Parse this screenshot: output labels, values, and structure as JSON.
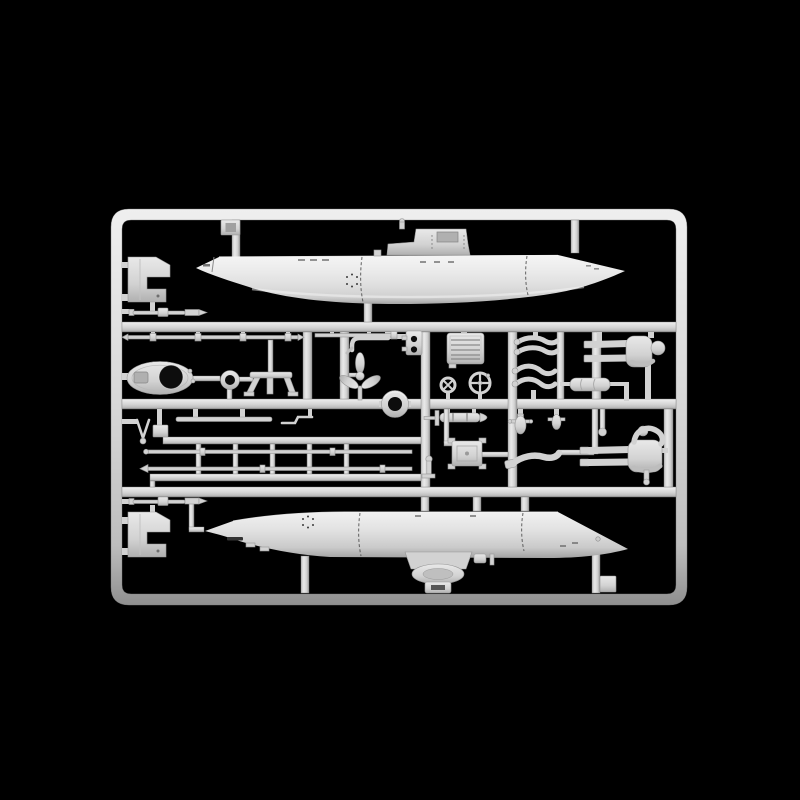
{
  "photo": {
    "subject": "plastic-model-sprue",
    "alt_label": "Light-gray injection-molded model kit sprue on a black background: two midget-submarine hull halves, crew figures, propeller, handwheels, rods and small fittings attached to a rectangular runner frame"
  },
  "colors": {
    "background": "#000000",
    "plastic_base": "#d2d2d2",
    "plastic_light": "#e9e9e9",
    "plastic_highlight": "#f5f5f5",
    "plastic_mid": "#bdbdbd",
    "plastic_shadow": "#8f8f8f",
    "plastic_edge": "#979797",
    "hole_dark": "#0d0d0d",
    "panel_line": "#4a4a4a",
    "recess_gray": "#b0b0b0"
  },
  "sprue": {
    "frame_shape": "rounded-rectangle",
    "parts": [
      {
        "id": "upper-hull-half",
        "label": "submarine upper hull half with conning tower"
      },
      {
        "id": "lower-hull-half",
        "label": "submarine lower hull half with keel drum fitting"
      },
      {
        "id": "mounting-bracket-top",
        "label": "stepped bracket plate"
      },
      {
        "id": "mounting-bracket-bottom",
        "label": "stepped bracket plate"
      },
      {
        "id": "barrel-rod-top",
        "label": "rod with collar and tapered tip"
      },
      {
        "id": "barrel-rod-bottom",
        "label": "rod with collar and tapered tip"
      },
      {
        "id": "pointed-rod-long",
        "label": "long thin rod with arrow tips"
      },
      {
        "id": "pointed-rod-short",
        "label": "short thin rod"
      },
      {
        "id": "rod-rack",
        "label": "ladder of stacked thin rods"
      },
      {
        "id": "zigzag-rod",
        "label": "small z-bent rod"
      },
      {
        "id": "wishbone-part",
        "label": "v-shaped link with eyelet"
      },
      {
        "id": "small-bracket",
        "label": "small square bracket"
      },
      {
        "id": "oval-hatch-coaming",
        "label": "oval plate with round opening"
      },
      {
        "id": "ring-collar",
        "label": "small ring collar"
      },
      {
        "id": "equipment-mount",
        "label": "a-frame equipment mount"
      },
      {
        "id": "towing-hook",
        "label": "hooked rod"
      },
      {
        "id": "hinge-bracket",
        "label": "plate with two holes"
      },
      {
        "id": "vent-grille-panel",
        "label": "rectangular grille panel"
      },
      {
        "id": "propeller",
        "label": "three-blade propeller with shaft"
      },
      {
        "id": "large-ring",
        "label": "large ring gasket"
      },
      {
        "id": "handwheel-x-spoke",
        "label": "small valve handwheel, x spokes"
      },
      {
        "id": "handwheel-cross-spoke",
        "label": "large valve handwheel, cross spokes"
      },
      {
        "id": "torpedo-cylinder",
        "label": "finned cylindrical body"
      },
      {
        "id": "access-hatch",
        "label": "hatch plate with corner pins"
      },
      {
        "id": "valve-pin",
        "label": "flanged pin"
      },
      {
        "id": "crew-arms-upper",
        "label": "pair of crew figure arms"
      },
      {
        "id": "crew-arms-lower",
        "label": "pair of crew figure arms"
      },
      {
        "id": "crew-figure-standing",
        "label": "crew figure, standing pose"
      },
      {
        "id": "crew-figure-crouched",
        "label": "crew figure, crouched pose with raised arm"
      },
      {
        "id": "crew-leg",
        "label": "single crew figure leg with boot"
      },
      {
        "id": "bottle-valve-a",
        "label": "small bottle with cross pin"
      },
      {
        "id": "bottle-valve-b",
        "label": "small bottle"
      },
      {
        "id": "bedroll-cylinder",
        "label": "small segmented cylinder"
      },
      {
        "id": "ball-pin",
        "label": "pin with ball end"
      },
      {
        "id": "sprue-tab-top",
        "label": "molding tab"
      },
      {
        "id": "sprue-tab-bottom",
        "label": "molding tab"
      }
    ]
  }
}
